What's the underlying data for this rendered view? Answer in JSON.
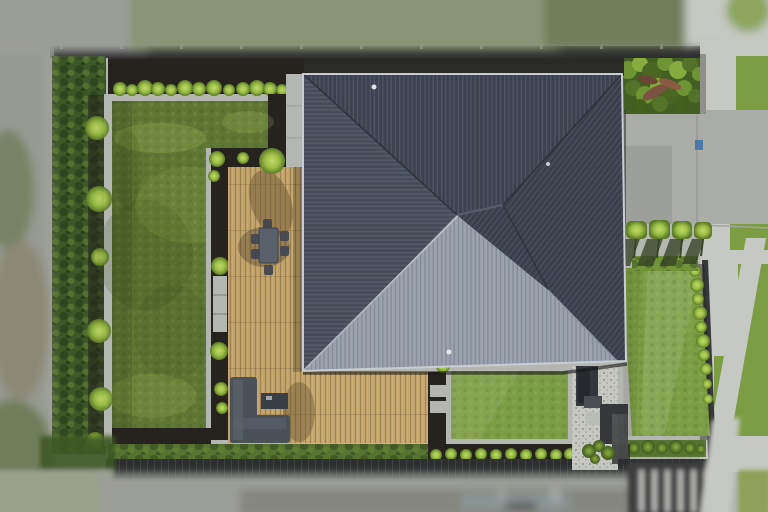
{
  "meta": {
    "title": "Aerial drone photo of residential property",
    "width": 768,
    "height": 512,
    "subject": "top-down view of house with dark hip roof, timber deck, lawns and hedges"
  },
  "palette": {
    "concrete": "#b4b6b1",
    "concrete_light": "#c6c8c3",
    "concrete_drive": "#a9aca7",
    "concrete_dark": "#999c97",
    "lawn_back": "#5f7734",
    "lawn_front": "#7d9d44",
    "hedge_dark": "#3d5726",
    "hedge_mid": "#577231",
    "shrub_lime": "#a6c44d",
    "mulch": "#26231f",
    "deck_wood": "#bfa069",
    "deck_wood_light": "#c9ac74",
    "roof_dark": "#3d424e",
    "roof_left": "#474c59",
    "roof_right": "#3a3f4b",
    "roof_light": "#9ba2ad",
    "gutter": "#c9cdd3",
    "fence": "#2d2e30",
    "fence_cap": "#9c9e9a",
    "sofa_gray": "#4b5159",
    "table_gray": "#596069",
    "street_blur": "#9b9d98",
    "street_dark": "#84867f",
    "field_blur": "#8a9476",
    "field_dark": "#6f7d5a",
    "bin_blue": "#4472a8",
    "pebble": "#c7c8c2",
    "stone_wall": "#35373b",
    "garden_bed": "#445d23",
    "shadow": "#1d1c1a"
  },
  "generated": [
    {
      "target": "g-fence-posts",
      "tag": "rect",
      "name": "fence-post",
      "common": {
        "width": 3,
        "height": 6,
        "fill": "#b9bab6",
        "opacity": 0.7
      },
      "items": [
        {
          "x": 60,
          "y": 43
        },
        {
          "x": 120,
          "y": 43
        },
        {
          "x": 180,
          "y": 43
        },
        {
          "x": 240,
          "y": 43
        },
        {
          "x": 300,
          "y": 43
        },
        {
          "x": 360,
          "y": 43
        },
        {
          "x": 420,
          "y": 43
        },
        {
          "x": 480,
          "y": 43
        },
        {
          "x": 540,
          "y": 43
        },
        {
          "x": 600,
          "y": 43
        },
        {
          "x": 660,
          "y": 43
        }
      ]
    },
    {
      "target": "g-top-shrubs",
      "tag": "circle",
      "name": "buxus-ball-shrub",
      "common": {
        "fill": "url(#gradShrub)"
      },
      "items": [
        {
          "cx": 120,
          "cy": 89,
          "r": 7
        },
        {
          "cx": 132,
          "cy": 90,
          "r": 6
        },
        {
          "cx": 145,
          "cy": 88,
          "r": 8
        },
        {
          "cx": 158,
          "cy": 89,
          "r": 7
        },
        {
          "cx": 171,
          "cy": 90,
          "r": 6
        },
        {
          "cx": 185,
          "cy": 88,
          "r": 8
        },
        {
          "cx": 199,
          "cy": 89,
          "r": 7
        },
        {
          "cx": 214,
          "cy": 88,
          "r": 8
        },
        {
          "cx": 229,
          "cy": 90,
          "r": 6
        },
        {
          "cx": 243,
          "cy": 89,
          "r": 7
        },
        {
          "cx": 257,
          "cy": 88,
          "r": 8
        },
        {
          "cx": 270,
          "cy": 89,
          "r": 7
        },
        {
          "cx": 282,
          "cy": 90,
          "r": 6
        },
        {
          "cx": 293,
          "cy": 89,
          "r": 7
        }
      ]
    },
    {
      "target": "g-left-hedge-balls",
      "tag": "circle",
      "name": "hedge-ball-shrub",
      "common": {
        "fill": "url(#gradShrub)",
        "opacity": 0.95
      },
      "items": [
        {
          "cx": 97,
          "cy": 128,
          "r": 12
        },
        {
          "cx": 99,
          "cy": 199,
          "r": 13
        },
        {
          "cx": 100,
          "cy": 257,
          "r": 9
        },
        {
          "cx": 99,
          "cy": 331,
          "r": 12
        },
        {
          "cx": 101,
          "cy": 399,
          "r": 12
        },
        {
          "cx": 95,
          "cy": 441,
          "r": 9
        }
      ]
    },
    {
      "target": "g-deckcol-shrubs",
      "tag": "circle",
      "name": "border-shrub",
      "common": {
        "fill": "url(#gradShrub)"
      },
      "items": [
        {
          "cx": 217,
          "cy": 159,
          "r": 8
        },
        {
          "cx": 214,
          "cy": 176,
          "r": 6
        },
        {
          "cx": 220,
          "cy": 266,
          "r": 9
        },
        {
          "cx": 219,
          "cy": 351,
          "r": 9
        },
        {
          "cx": 221,
          "cy": 389,
          "r": 7
        },
        {
          "cx": 222,
          "cy": 408,
          "r": 6
        }
      ]
    },
    {
      "target": "g-decktop-shrubs",
      "tag": "circle",
      "name": "deck-corner-shrub",
      "common": {
        "fill": "url(#gradShrub)"
      },
      "items": [
        {
          "cx": 272,
          "cy": 161,
          "r": 13
        },
        {
          "cx": 243,
          "cy": 158,
          "r": 6
        }
      ]
    },
    {
      "target": "g-front-shrubs",
      "tag": "circle",
      "name": "front-border-shrub",
      "common": {
        "fill": "url(#gradShrub)"
      },
      "items": [
        {
          "cx": 436,
          "cy": 455,
          "r": 6
        },
        {
          "cx": 451,
          "cy": 454,
          "r": 6
        },
        {
          "cx": 466,
          "cy": 455,
          "r": 6
        },
        {
          "cx": 481,
          "cy": 454,
          "r": 6
        },
        {
          "cx": 496,
          "cy": 455,
          "r": 6
        },
        {
          "cx": 511,
          "cy": 454,
          "r": 6
        },
        {
          "cx": 526,
          "cy": 455,
          "r": 6
        },
        {
          "cx": 541,
          "cy": 454,
          "r": 6
        },
        {
          "cx": 556,
          "cy": 455,
          "r": 6
        },
        {
          "cx": 570,
          "cy": 454,
          "r": 6
        },
        {
          "cx": 584,
          "cy": 455,
          "r": 6
        }
      ]
    },
    {
      "target": "g-se-hedge-balls",
      "tag": "circle",
      "name": "se-hedge-shrub",
      "common": {
        "fill": "url(#gradShrubD)"
      },
      "items": [
        {
          "cx": 634,
          "cy": 448,
          "r": 6
        },
        {
          "cx": 648,
          "cy": 447,
          "r": 7
        },
        {
          "cx": 662,
          "cy": 448,
          "r": 6
        },
        {
          "cx": 676,
          "cy": 447,
          "r": 7
        },
        {
          "cx": 690,
          "cy": 448,
          "r": 6
        },
        {
          "cx": 701,
          "cy": 449,
          "r": 5
        }
      ]
    },
    {
      "target": "g-right-hedge-balls",
      "tag": "circle",
      "name": "boundary-hedge-shrub",
      "common": {
        "fill": "url(#gradShrub)"
      },
      "items": [
        {
          "cx": 695,
          "cy": 271,
          "r": 6
        },
        {
          "cx": 697,
          "cy": 285,
          "r": 7
        },
        {
          "cx": 698,
          "cy": 299,
          "r": 6
        },
        {
          "cx": 700,
          "cy": 313,
          "r": 7
        },
        {
          "cx": 701,
          "cy": 327,
          "r": 6
        },
        {
          "cx": 703,
          "cy": 341,
          "r": 7
        },
        {
          "cx": 704,
          "cy": 355,
          "r": 6
        },
        {
          "cx": 706,
          "cy": 369,
          "r": 6
        },
        {
          "cx": 707,
          "cy": 384,
          "r": 5
        },
        {
          "cx": 708,
          "cy": 399,
          "r": 5
        }
      ]
    },
    {
      "target": "g-entry-plants",
      "tag": "circle",
      "name": "entry-plant",
      "common": {
        "fill": "url(#gradShrubD)"
      },
      "items": [
        {
          "cx": 589,
          "cy": 451,
          "r": 7
        },
        {
          "cx": 599,
          "cy": 446,
          "r": 6
        },
        {
          "cx": 608,
          "cy": 453,
          "r": 7
        },
        {
          "cx": 595,
          "cy": 459,
          "r": 5
        }
      ]
    },
    {
      "target": "g-lawn-corner-shrub",
      "tag": "circle",
      "name": "lawn-corner-shrub",
      "common": {
        "fill": "url(#gradShrub)"
      },
      "items": [
        {
          "cx": 443,
          "cy": 366,
          "r": 7
        }
      ]
    },
    {
      "target": "g-bed-blobs",
      "tag": "circle",
      "name": "garden-plant",
      "common": {},
      "items": [
        {
          "cx": 628,
          "cy": 70,
          "r": 9,
          "fill": "#6f9434"
        },
        {
          "cx": 640,
          "cy": 64,
          "r": 8,
          "fill": "#87ab3f"
        },
        {
          "cx": 652,
          "cy": 72,
          "r": 10,
          "fill": "#4a6622"
        },
        {
          "cx": 665,
          "cy": 63,
          "r": 8,
          "fill": "#6f9434"
        },
        {
          "cx": 678,
          "cy": 70,
          "r": 9,
          "fill": "#87ab3f"
        },
        {
          "cx": 690,
          "cy": 64,
          "r": 8,
          "fill": "#55722a"
        },
        {
          "cx": 699,
          "cy": 74,
          "r": 7,
          "fill": "#6f9434"
        },
        {
          "cx": 633,
          "cy": 88,
          "r": 8,
          "fill": "#55722a"
        },
        {
          "cx": 645,
          "cy": 95,
          "r": 9,
          "fill": "#6f9434"
        },
        {
          "cx": 658,
          "cy": 86,
          "r": 8,
          "fill": "#87ab3f"
        },
        {
          "cx": 670,
          "cy": 95,
          "r": 9,
          "fill": "#4a6622"
        },
        {
          "cx": 684,
          "cy": 88,
          "r": 8,
          "fill": "#6f9434"
        },
        {
          "cx": 695,
          "cy": 96,
          "r": 7,
          "fill": "#55722a"
        },
        {
          "cx": 640,
          "cy": 106,
          "r": 7,
          "fill": "#46611f"
        },
        {
          "cx": 660,
          "cy": 104,
          "r": 8,
          "fill": "#55722a"
        },
        {
          "cx": 680,
          "cy": 104,
          "r": 7,
          "fill": "#46611f"
        }
      ]
    },
    {
      "target": "g-flax",
      "tag": "ellipse",
      "name": "flax-plant",
      "common": {},
      "items": [
        {
          "cx": 655,
          "cy": 92,
          "rx": 14,
          "ry": 5,
          "fill": "#7b5240",
          "transform": "rotate(-30 655 92)"
        },
        {
          "cx": 670,
          "cy": 84,
          "rx": 12,
          "ry": 4,
          "fill": "#8a5c42",
          "transform": "rotate(20 670 84)"
        },
        {
          "cx": 648,
          "cy": 80,
          "rx": 10,
          "ry": 4,
          "fill": "#6b4736",
          "transform": "rotate(10 648 80)"
        }
      ]
    },
    {
      "target": "g-tree-canopies",
      "tag": "rect",
      "name": "pleached-tree-canopy",
      "common": {
        "rx": 5,
        "fill": "url(#gradShrub)"
      },
      "items": [
        {
          "x": 626,
          "y": 221,
          "width": 21,
          "height": 18
        },
        {
          "x": 649,
          "y": 220,
          "width": 21,
          "height": 19
        },
        {
          "x": 672,
          "y": 221,
          "width": 20,
          "height": 18
        },
        {
          "x": 694,
          "y": 222,
          "width": 18,
          "height": 17
        }
      ]
    },
    {
      "target": "g-tree-shadows",
      "tag": "polygon",
      "name": "tree-shadow",
      "common": {
        "fill": "#333e23",
        "opacity": 0.75
      },
      "items": [
        {
          "points": "624,239 640,239 630,266 614,266"
        },
        {
          "points": "647,239 663,239 653,266 637,266"
        },
        {
          "points": "670,239 684,239 675,266 660,266"
        },
        {
          "points": "692,239 704,239 696,264 682,264"
        }
      ]
    },
    {
      "target": "g-tree-trunks",
      "tag": "line",
      "name": "tree-trunk",
      "common": {
        "stroke": "#3a4426",
        "stroke-width": 2
      },
      "items": [
        {
          "x1": 636,
          "y1": 239,
          "x2": 634,
          "y2": 258
        },
        {
          "x1": 659,
          "y1": 239,
          "x2": 657,
          "y2": 258
        },
        {
          "x1": 682,
          "y1": 239,
          "x2": 680,
          "y2": 258
        },
        {
          "x1": 703,
          "y1": 239,
          "x2": 701,
          "y2": 256
        }
      ]
    },
    {
      "target": "g-mottle",
      "tag": "ellipse",
      "name": "lawn-mottle-patch",
      "common": {},
      "items": [
        {
          "cx": 160,
          "cy": 138,
          "rx": 46,
          "ry": 15,
          "fill": "#b9d468",
          "opacity": 0.2
        },
        {
          "cx": 248,
          "cy": 122,
          "rx": 26,
          "ry": 11,
          "fill": "#b9d468",
          "opacity": 0.18
        },
        {
          "cx": 145,
          "cy": 255,
          "rx": 48,
          "ry": 55,
          "fill": "#2e4215",
          "opacity": 0.16
        },
        {
          "cx": 172,
          "cy": 332,
          "rx": 38,
          "ry": 48,
          "fill": "#2e4215",
          "opacity": 0.13
        },
        {
          "cx": 152,
          "cy": 396,
          "rx": 44,
          "ry": 22,
          "fill": "#b9d468",
          "opacity": 0.15
        },
        {
          "cx": 230,
          "cy": 295,
          "rx": 22,
          "ry": 55,
          "fill": "#2e4215",
          "opacity": 0.12
        },
        {
          "cx": 190,
          "cy": 205,
          "rx": 55,
          "ry": 38,
          "fill": "#b9d468",
          "opacity": 0.11
        },
        {
          "cx": 128,
          "cy": 170,
          "rx": 14,
          "ry": 40,
          "fill": "#2e4215",
          "opacity": 0.15
        }
      ]
    },
    {
      "target": "g-chairs",
      "tag": "rect",
      "name": "dining-chair",
      "common": {
        "width": 9,
        "height": 10,
        "rx": 2,
        "fill": "#42474f",
        "opacity": 0.95
      },
      "items": [
        {
          "x": 251,
          "y": 234
        },
        {
          "x": 251,
          "y": 249
        },
        {
          "x": 280,
          "y": 231
        },
        {
          "x": 280,
          "y": 246
        },
        {
          "x": 263,
          "y": 219
        },
        {
          "x": 264,
          "y": 265
        }
      ]
    },
    {
      "target": "g-street-stripes",
      "tag": "rect",
      "name": "neighbor-roof-stripe",
      "common": {
        "width": 5,
        "height": 42,
        "fill": "#cfd1ce",
        "opacity": 0.85
      },
      "items": [
        {
          "x": 639,
          "y": 470
        },
        {
          "x": 652,
          "y": 470
        },
        {
          "x": 665,
          "y": 470
        },
        {
          "x": 678,
          "y": 470
        },
        {
          "x": 691,
          "y": 470
        },
        {
          "x": 704,
          "y": 470
        }
      ]
    }
  ]
}
